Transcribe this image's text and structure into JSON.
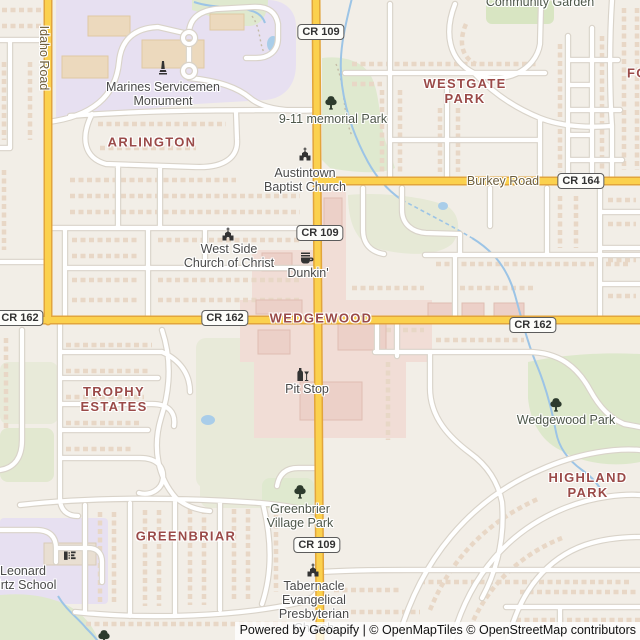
{
  "colors": {
    "background": "#f2eee7",
    "road_primary": "#fbd14e",
    "road_primary_casing": "#e2a53c",
    "road_minor": "#ffffff",
    "park_green": "#dde9cc",
    "field_green": "#e7e9d8",
    "education_purple": "#e7e0f1",
    "commercial_pink": "#f1ddd6",
    "water_blue": "#a9cde9",
    "neighborhood_label": "#9a4a48",
    "poi_label": "#4a4a4a"
  },
  "shields": {
    "cr109": "CR 109",
    "cr162": "CR 162",
    "cr164": "CR 164"
  },
  "roads": {
    "idaho": "Idaho Road",
    "burkey": "Burkey Road"
  },
  "neighborhoods": {
    "arlington": "ARLINGTON",
    "westgate1": "WESTGATE",
    "westgate2": "PARK",
    "wedgewood": "WEDGEWOOD",
    "trophy1": "TROPHY",
    "trophy2": "ESTATES",
    "highland1": "HIGHLAND",
    "highland2": "PARK",
    "greenbriar": "GREENBRIAR",
    "edge_fragment": "FO"
  },
  "parks": {
    "community_garden": "Community Garden",
    "memorial": "9-11 memorial Park",
    "wedgewood_park": "Wedgewood Park",
    "greenbrier1": "Greenbrier",
    "greenbrier2": "Village Park"
  },
  "pois": {
    "marines1": "Marines Servicemen",
    "marines2": "Monument",
    "austintown1": "Austintown",
    "austintown2": "Baptist Church",
    "westside1": "West Side",
    "westside2": "Church of Christ",
    "dunkin": "Dunkin'",
    "pitstop": "Pit Stop",
    "school1": "Leonard",
    "school2": "Kirtz School",
    "tabernacle1": "Tabernacle",
    "tabernacle2": "Evangelical",
    "tabernacle3": "Presbyterian",
    "tabernacle4": "Church"
  },
  "attribution": {
    "powered_by": "Powered by ",
    "geoapify": "Geoapify",
    "sep": " | © ",
    "openmaptiles": "OpenMapTiles",
    "sep2": " © ",
    "openstreetmap": "OpenStreetMap",
    "suffix": " contributors"
  }
}
